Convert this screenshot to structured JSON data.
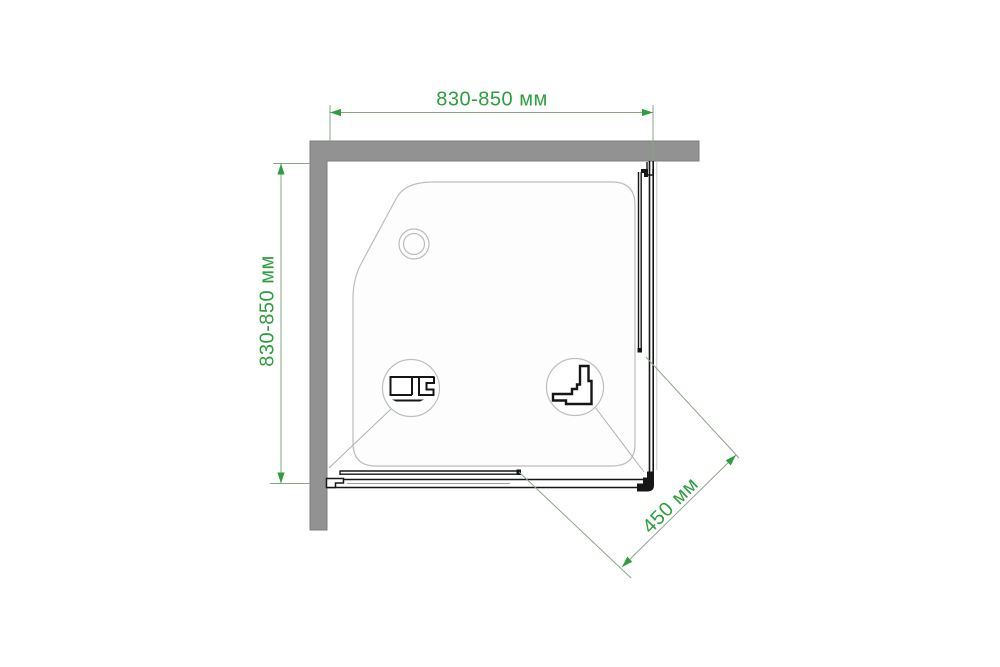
{
  "dimensions": {
    "width_top": "830-850 мм",
    "depth_left": "830-850 мм",
    "entry_diagonal": "450 мм"
  },
  "colors": {
    "dimension_green": "#2d9e3e",
    "extension_line_gray_green": "#8aa68a",
    "leader_line": "#aab4aa",
    "wall_gray": "#929292",
    "drawing_black": "#161616",
    "tray_outline": "#bcbcbc"
  },
  "icons": {
    "drain": "drain-icon",
    "bottom_rail_profile": "bottom-rail-profile-icon",
    "corner_connector_profile": "corner-profile-icon"
  }
}
